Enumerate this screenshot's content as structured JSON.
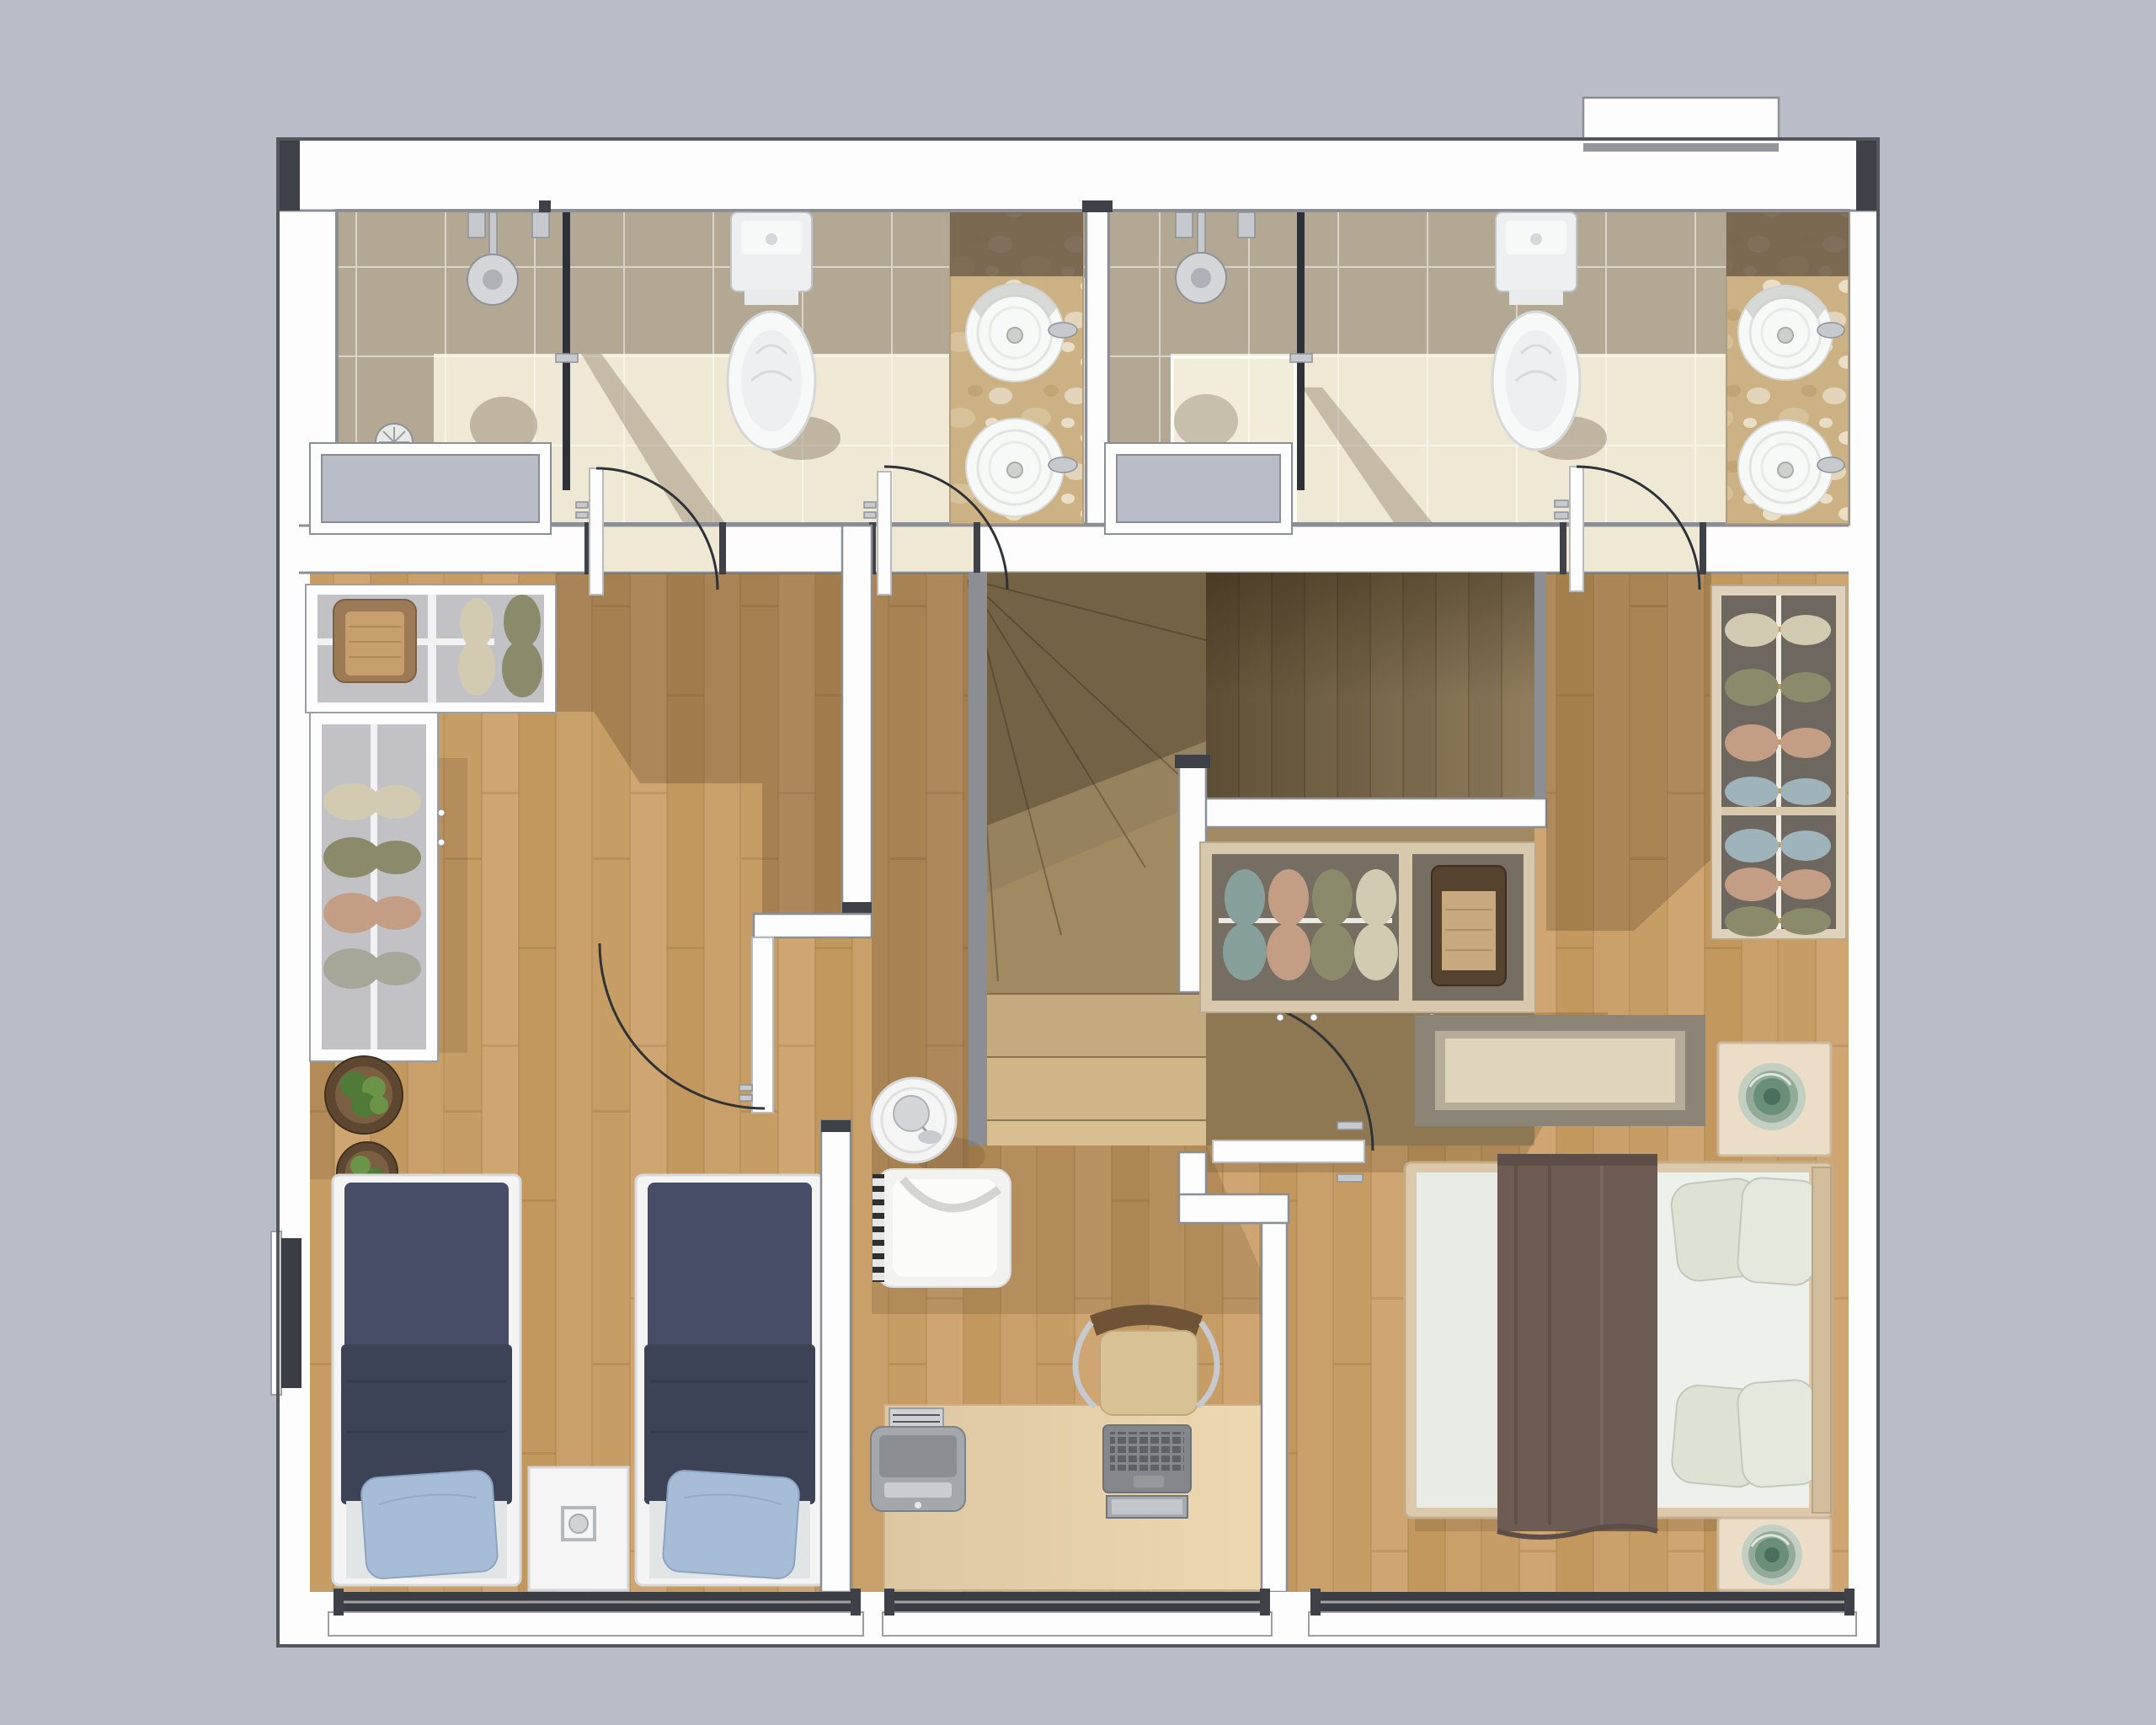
{
  "colors": {
    "bg": "#b9bdc7",
    "wallFill": "#fdfdfd",
    "wallEdge": "#8b8e95",
    "wallDark": "#3e4147",
    "outerLine": "#54575d",
    "tileLight": "#efe8d5",
    "tileDark": "#b3a893",
    "trayLight": "#f2ecdb",
    "glass": "#2e3136",
    "chrome": "#c6c9ce",
    "chromeDark": "#8e9196",
    "porcelain": "#f7f8f8",
    "porcelainInner": "#edeff0",
    "fixtureEdge": "#c2c5c8",
    "marbleBase": "#cbb183",
    "marbleDark": "#6e5d49",
    "woodA": "#c79d66",
    "woodB": "#cfa571",
    "woodC": "#c2985f",
    "woodD": "#caa06a",
    "woodSeam": "#a5814c",
    "stairBase": "#a18a62",
    "stairPlankA": "#8c795a",
    "stairPlankB": "#93805f",
    "stairSeam": "#6b5b41",
    "stairStep1": "#c5ac80",
    "stairStep2": "#cfb689",
    "stairStep3": "#d8bf92",
    "shadowBrown": "#46321a",
    "closetGray": "#c1c1c6",
    "closetShelf": "#f2f2f4",
    "closetDark": "#766d63",
    "closetFrame": "#d9c9ac",
    "wardrobeFrame": "#ded2bc",
    "wardrobeDark": "#6e6760",
    "garmentCream": "#d2cab1",
    "garmentOlive": "#8b8b6b",
    "garmentPink": "#c49d85",
    "garmentGray": "#a6a699",
    "garmentTeal": "#87a09c",
    "garmentBlue": "#9fb3bb",
    "hanger": "#c9984f",
    "boxDark": "#55422f",
    "boxLid": "#c8a87e",
    "basket": "#9c7a55",
    "basketInner": "#c79e6e",
    "bedFrame": "#f4f4f4",
    "navyA": "#474d66",
    "navyB": "#3d4357",
    "navyFold": "#343a4c",
    "sheet": "#e2e5e6",
    "pillowBlue": "#a7bcd6",
    "pillowBlueEdge": "#8da3c0",
    "bedWood": "#dcc9ab",
    "duvetGreen": "#e7ece5",
    "duvetLight": "#edf1ec",
    "pillowGreen": "#dde2d5",
    "pillowGreenEdge": "#c2c8ba",
    "throwBrown": "#6d5c54",
    "throwDark": "#5d4e47",
    "headboard": "#d2bd9c",
    "rugBorder": "#8c8477",
    "rugMid": "#b5ad9a",
    "rugCenter": "#ded5bc",
    "nightstand": "#ecddc8",
    "nightstandEdge": "#cbb99d",
    "whiteFurn": "#f5f5f5",
    "decoA": "#c3cfc2",
    "decoB": "#93ab98",
    "decoC": "#6a8f79",
    "decoD": "#48705c",
    "deskA": "#dcc7a2",
    "deskB": "#eed9b2",
    "deskEdge": "#c6b18c",
    "chairBack": "#6e5337",
    "chairSeat": "#d8c295",
    "chairSeatEdge": "#bfa87e",
    "laptopBody": "#84878c",
    "laptopKeys": "#5d6065",
    "laptopScreen": "#c3c7cb",
    "printerBody": "#a4a7ac",
    "printerDark": "#8b8e93",
    "printerSlot": "#c9ccd0",
    "paper": "#cfd1d4",
    "paperLine": "#55585c",
    "armchair": "#f2f2f1",
    "armchairCushion": "#fbfbfa",
    "armchairBand": "#cdcdc9",
    "lampGray": "#d4d6d9",
    "potDark": "#5d4731",
    "potMid": "#7a5f42",
    "plantA": "#4f7a38",
    "plantB": "#6b9448",
    "windowGlass": "#3a3d43",
    "sill": "#fdfdfd"
  },
  "rooms": [
    {
      "id": "left-bathroom",
      "items": [
        "shower",
        "shower-valves",
        "floor-drain",
        "glass-partition",
        "toilet",
        "marble-vanity",
        "vessel-sink",
        "vessel-sink",
        "faucet",
        "door",
        "door"
      ]
    },
    {
      "id": "right-bathroom",
      "items": [
        "shower",
        "shower-valves",
        "shower-tray",
        "floor-drain",
        "glass-partition",
        "toilet",
        "marble-vanity",
        "vessel-sink",
        "vessel-sink",
        "faucet",
        "door"
      ]
    },
    {
      "id": "left-bedroom",
      "items": [
        "l-shaped-closet",
        "hanging-clothes",
        "wicker-basket",
        "potted-plant",
        "potted-plant",
        "twin-bed",
        "twin-bed",
        "blue-pillow",
        "blue-pillow",
        "nightstand",
        "door",
        "window"
      ]
    },
    {
      "id": "study",
      "items": [
        "round-side-table",
        "table-lamp",
        "armchair",
        "fringed-throw",
        "desk",
        "office-chair",
        "laptop",
        "printer",
        "paper-stack",
        "window"
      ]
    },
    {
      "id": "staircase",
      "items": [
        "upper-flight",
        "winder-steps",
        "lower-steps",
        "landing"
      ]
    },
    {
      "id": "right-bedroom",
      "items": [
        "under-stair-closet",
        "hanging-clothes",
        "storage-box",
        "wardrobe",
        "rug",
        "double-bed",
        "pillows",
        "throw-blanket",
        "nightstand",
        "nightstand",
        "green-glass-decor",
        "green-glass-decor",
        "door",
        "window"
      ]
    }
  ]
}
